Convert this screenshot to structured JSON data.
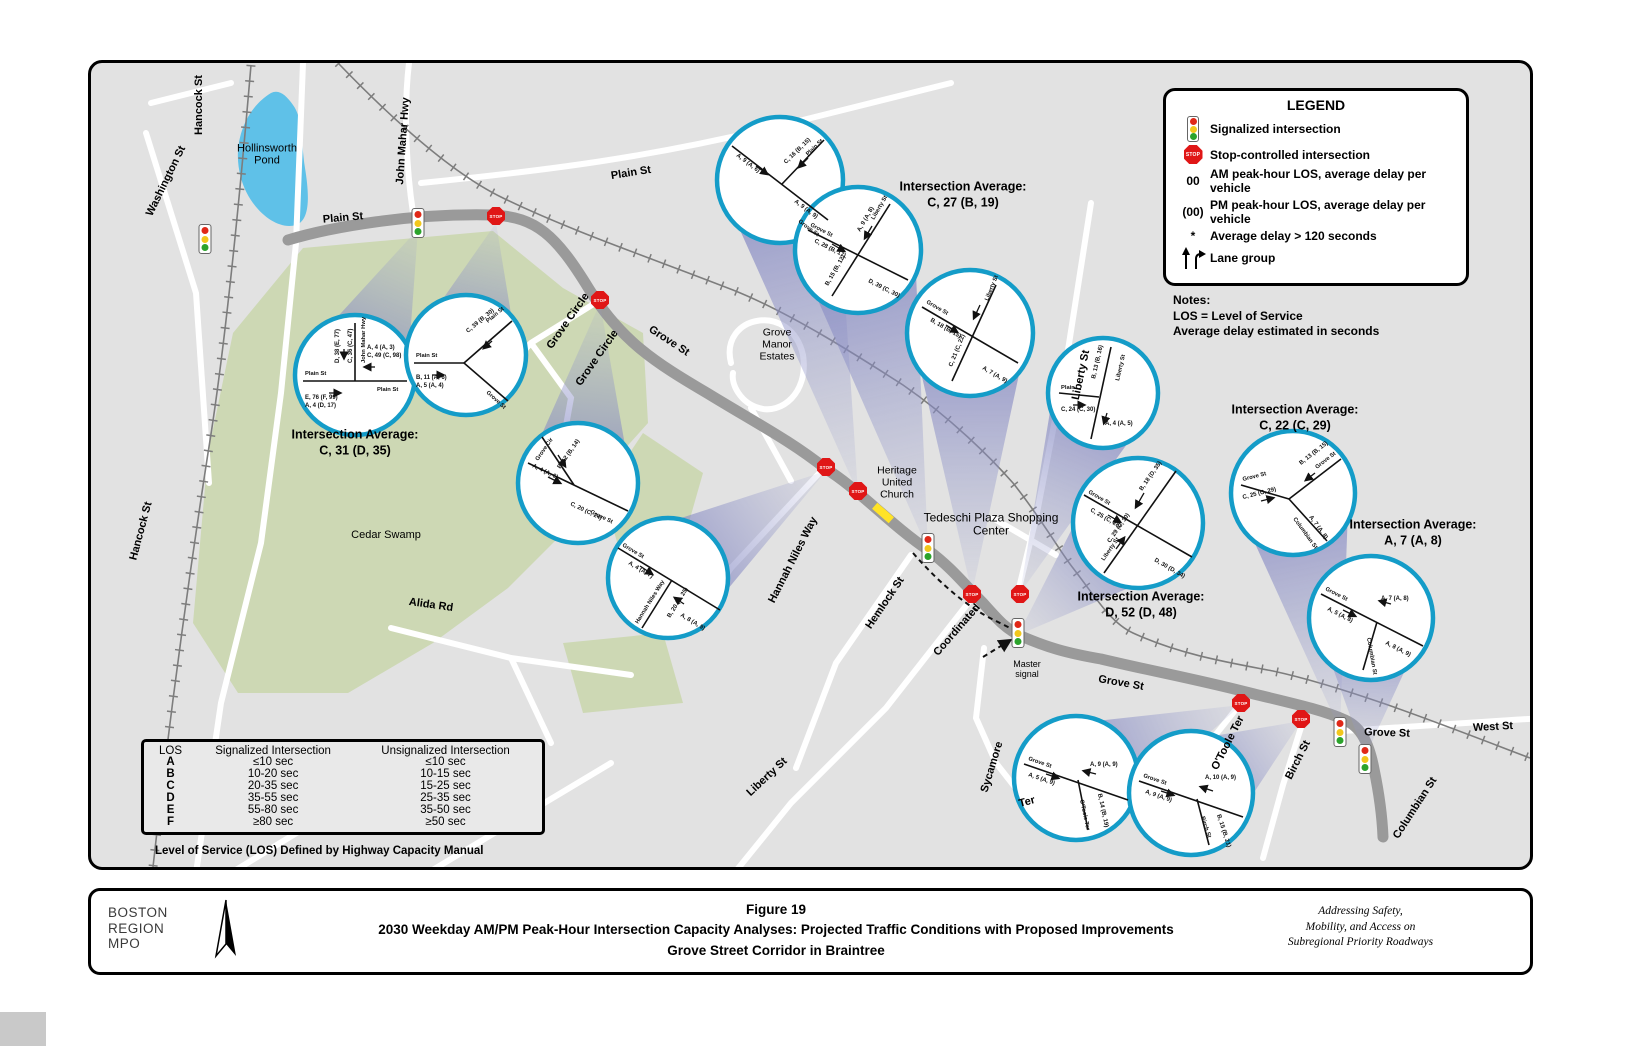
{
  "legend": {
    "title": "LEGEND",
    "items": [
      {
        "label": "Signalized intersection"
      },
      {
        "label": "Stop-controlled intersection"
      },
      {
        "symbol": "00",
        "label": "AM peak-hour LOS, average delay per vehicle"
      },
      {
        "symbol": "(00)",
        "label": "PM peak-hour LOS, average delay per vehicle"
      },
      {
        "symbol": "*",
        "label": "Average delay > 120 seconds"
      },
      {
        "label": "Lane group"
      }
    ],
    "notes_title": "Notes:",
    "note1": "LOS = Level of Service",
    "note2": "Average delay estimated in seconds"
  },
  "los_table": {
    "headers": [
      "LOS",
      "Signalized Intersection",
      "Unsignalized Intersection"
    ],
    "rows": [
      [
        "A",
        "≤10 sec",
        "≤10 sec"
      ],
      [
        "B",
        "10-20 sec",
        "10-15 sec"
      ],
      [
        "C",
        "20-35 sec",
        "15-25 sec"
      ],
      [
        "D",
        "35-55 sec",
        "25-35 sec"
      ],
      [
        "E",
        "55-80 sec",
        "35-50 sec"
      ],
      [
        "F",
        "≥80 sec",
        "≥50 sec"
      ]
    ],
    "caption": "Level of Service (LOS) Defined by Highway Capacity Manual"
  },
  "averages": [
    {
      "label": "Intersection Average:",
      "value": "C, 31 (D, 35)"
    },
    {
      "label": "Intersection Average:",
      "value": "C, 27 (B, 19)"
    },
    {
      "label": "Intersection Average:",
      "value": "C, 22 (C, 29)"
    },
    {
      "label": "Intersection Average:",
      "value": "A, 7 (A, 8)"
    },
    {
      "label": "Intersection Average:",
      "value": "D, 52 (D, 48)"
    }
  ],
  "map_labels": {
    "washington_st": "Washington St",
    "hancock_st_top": "Hancock St",
    "hancock_st_left": "Hancock St",
    "hollinsworth_pond": "Hollinsworth Pond",
    "plain_st_west": "Plain St",
    "plain_st_top": "Plain St",
    "john_mahar_hwy": "John Mahar Hwy",
    "grove_circle_a": "Grove Circle",
    "grove_circle_b": "Grove Circle",
    "grove_st_mid": "Grove St",
    "grove_manor_estates": "Grove Manor Estates",
    "cedar_swamp": "Cedar Swamp",
    "alida_rd": "Alida Rd",
    "heritage_united_church": "Heritage United Church",
    "tedeschi_plaza": "Tedeschi Plaza Shopping Center",
    "hannah_niles_way": "Hannah Niles Way",
    "hemlock_st": "Hemlock St",
    "liberty_st_upper": "Liberty St",
    "liberty_st_lower": "Liberty St",
    "coordinated": "Coordinated",
    "master_signal": "Master signal",
    "sycamore": "Sycamore",
    "ter": "Ter",
    "grove_st_lower": "Grove St",
    "otoole_ter": "O'Toole Ter",
    "birch_st": "Birch St",
    "grove_st_right": "Grove St",
    "west_st": "West St",
    "columbian_st": "Columbian St"
  },
  "icons": {
    "stop_sign_text": "STOP"
  },
  "callouts": [
    {
      "name": "plain-st-at-john-mahar-hwy",
      "streets": [
        "Plain St",
        "Plain St",
        "John Mahar Hwy"
      ],
      "los": [
        "C, 36 (C, 47)",
        "D, 38 (E, 77)",
        "E, 76 (F, 99)",
        "A, 4 (D, 17)",
        "A, 4 (A, 3)",
        "C, 49 (C, 98)"
      ]
    },
    {
      "name": "plain-st-at-grove-st",
      "streets": [
        "Plain St",
        "Plain St",
        "Grove St"
      ],
      "los": [
        "B, 11 (A, 6)",
        "A, 5 (A, 4)",
        "C, 39 (B, 30)"
      ]
    },
    {
      "name": "grove-st-at-grove-circle",
      "streets": [
        "Grove St",
        "Grove Cir"
      ],
      "los": [
        "A, 4 (A, 6)",
        "B, 12 (B, 14)",
        "C, 20 (C, 24)"
      ]
    },
    {
      "name": "grove-st-at-hannah-niles-way",
      "streets": [
        "Grove St",
        "Hannah Niles Way"
      ],
      "los": [
        "A, 4 (A, 7)",
        "B, 20 (C, 25)",
        "A, 8 (A, 9)"
      ]
    },
    {
      "name": "grove-st-at-plain-st",
      "streets": [
        "Grove St",
        "Plain St"
      ],
      "los": [
        "A, 9 (A, 6)",
        "C, 16 (B, 15)",
        "A, 9 (A, 9)"
      ]
    },
    {
      "name": "grove-st-at-liberty-st-north",
      "streets": [
        "Grove St",
        "Liberty St"
      ],
      "los": [
        "C, 28 (B, 17)",
        "B, 15 (B, 12)",
        "D, 39 (C, 30)",
        "A, 9 (A, 8)"
      ]
    },
    {
      "name": "grove-st-at-tedeschi-plaza",
      "streets": [
        "Grove St",
        "Liberty St"
      ],
      "los": [
        "B, 18 (B, 15)",
        "C, 21 (C, 22)",
        "A, 7 (A, 9)"
      ]
    },
    {
      "name": "plain-st-at-liberty-st",
      "streets": [
        "Plain",
        "Liberty St"
      ],
      "los": [
        "C, 24 (C, 30)",
        "B, 13 (B, 16)",
        "A, 4 (A, 5)"
      ]
    },
    {
      "name": "grove-st-at-liberty-st-south",
      "streets": [
        "Grove St",
        "Liberty St"
      ],
      "los": [
        "C, 25 (C, 28)",
        "B, 18 (D, 35)",
        "D, 30 (D, 34)",
        "C, 29 (C, 30)"
      ]
    },
    {
      "name": "grove-st-at-columbian-st",
      "streets": [
        "Grove St",
        "Grove St",
        "Columbian St"
      ],
      "los": [
        "C, 25 (C, 29)",
        "B, 13 (B, 15)",
        "A, 7 (A, 8)"
      ]
    },
    {
      "name": "grove-st-at-columbian-st-south",
      "streets": [
        "Grove St",
        "Columbian St"
      ],
      "los": [
        "A, 5 (A, 8)",
        "A, 8 (A, 9)",
        "A, 7 (A, 8)"
      ]
    },
    {
      "name": "grove-st-at-otoole-ter",
      "streets": [
        "Grove St",
        "O'Toole Ter"
      ],
      "los": [
        "A, 5 (A, 9)",
        "A, 9 (A, 9)",
        "B, 14 (B, 19)"
      ]
    },
    {
      "name": "grove-st-at-birch-st",
      "streets": [
        "Grove St",
        "Birch St"
      ],
      "los": [
        "A, 9 (A, 9)",
        "A, 10 (A, 9)",
        "B, 15 (B, 21)"
      ]
    }
  ],
  "footer": {
    "org_line1": "BOSTON",
    "org_line2": "REGION",
    "org_line3": "MPO",
    "figure": "Figure 19",
    "title": "2030 Weekday AM/PM Peak-Hour Intersection Capacity Analyses: Projected Traffic Conditions with Proposed Improvements",
    "subtitle": "Grove Street Corridor in Braintree",
    "tagline1": "Addressing Safety,",
    "tagline2": "Mobility, and Access on",
    "tagline3": "Subregional Priority Roadways"
  }
}
